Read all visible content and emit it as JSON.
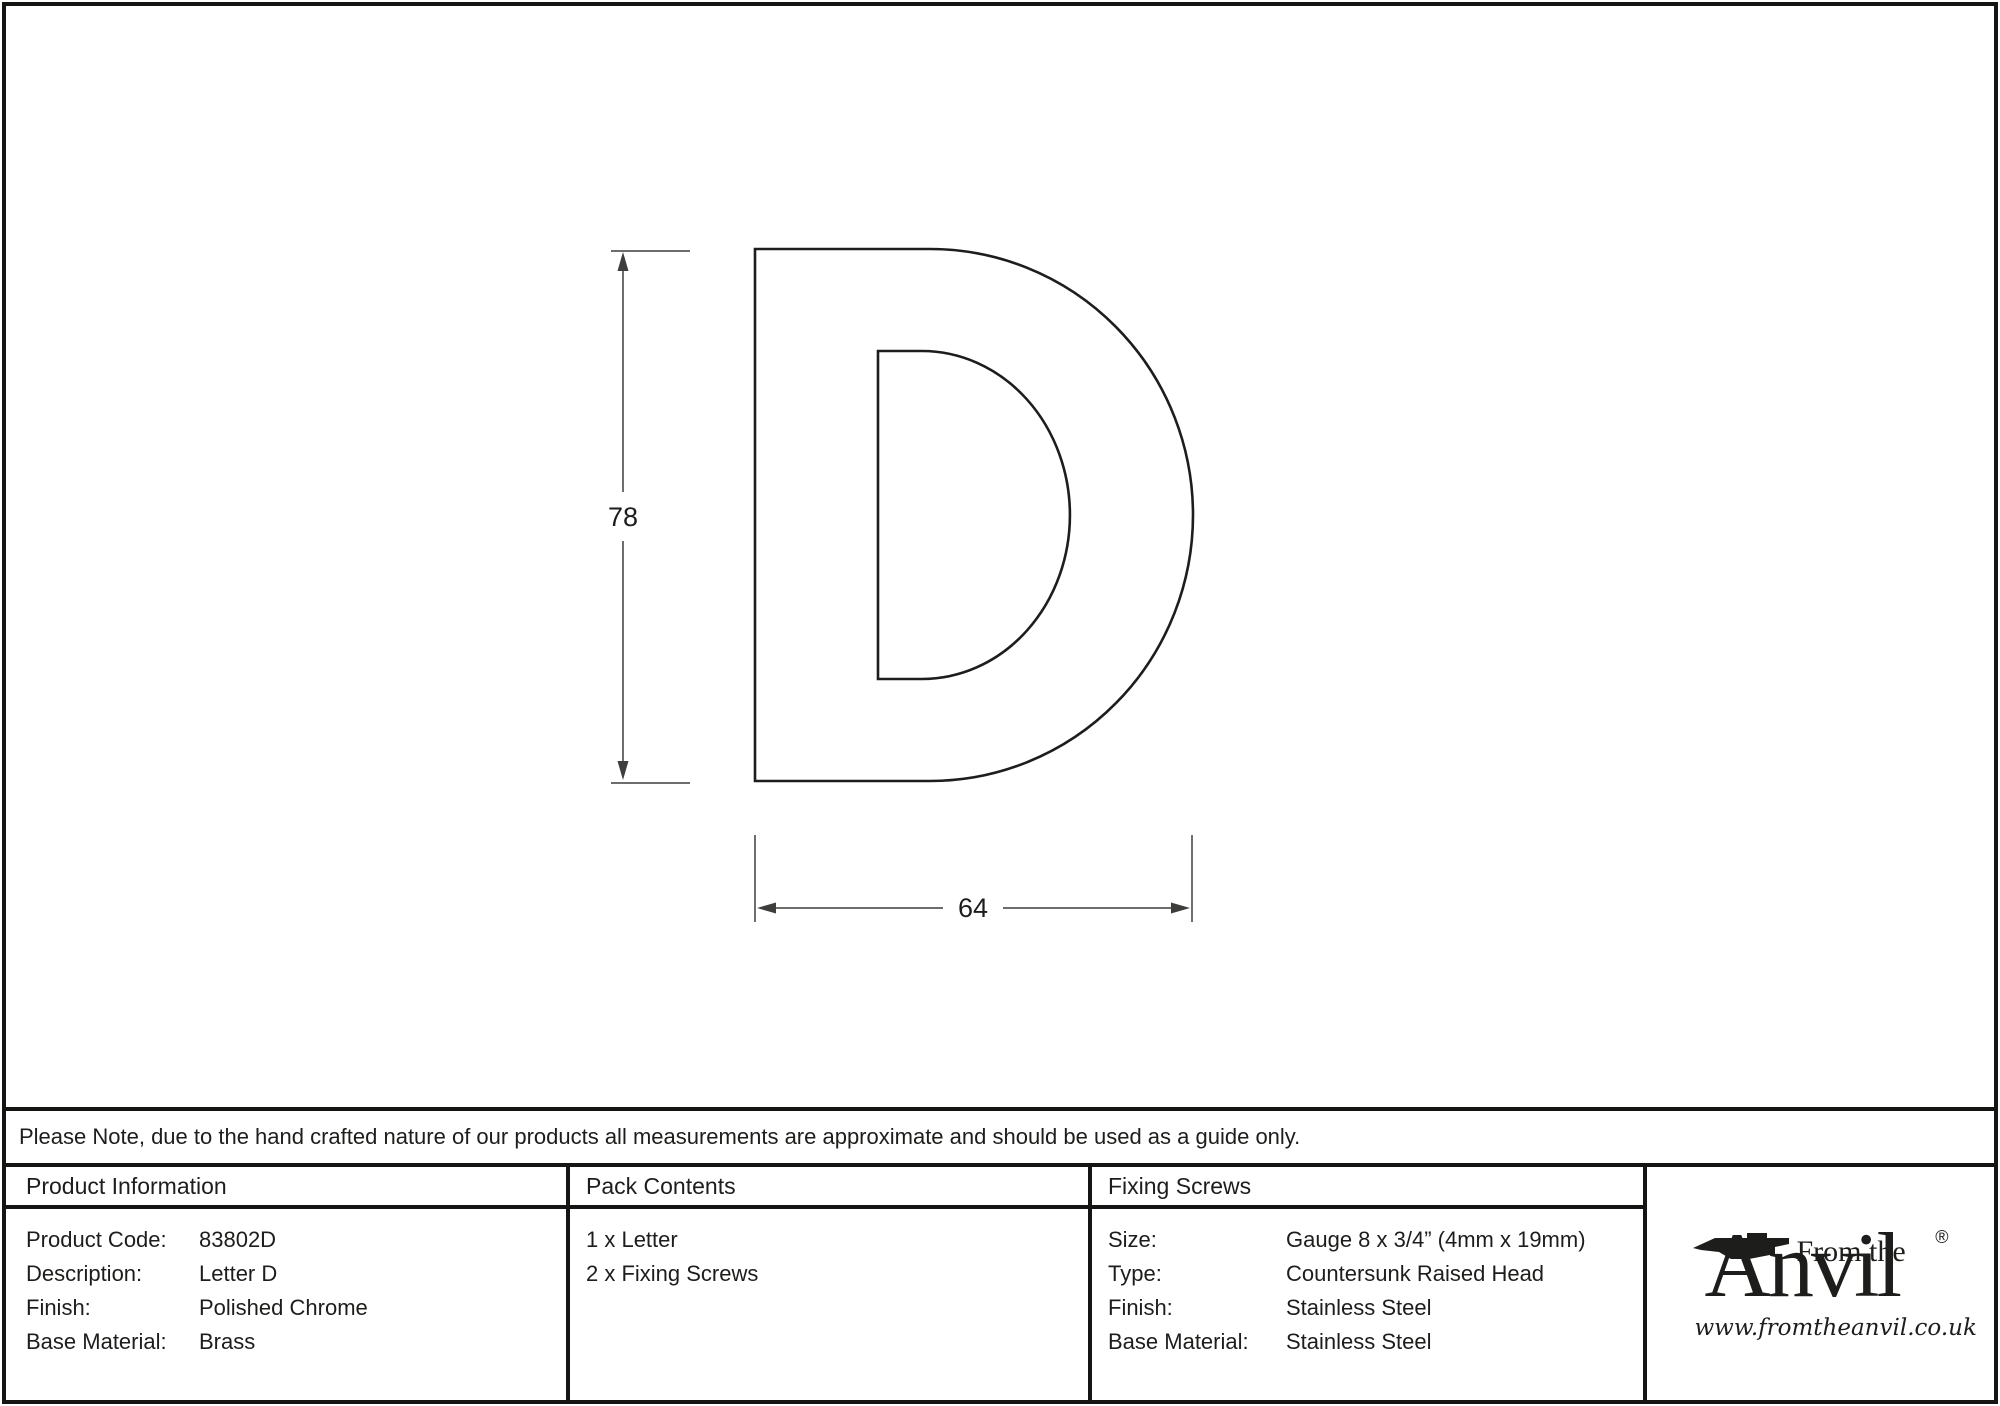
{
  "drawing": {
    "letter": "D",
    "height_label": "78",
    "width_label": "64"
  },
  "note": {
    "text": "Please Note, due to the hand crafted nature of our products all measurements are approximate and should be used as a guide only."
  },
  "product_information": {
    "header": "Product Information",
    "rows": [
      {
        "label": "Product Code:",
        "value": "83802D"
      },
      {
        "label": "Description:",
        "value": "Letter D"
      },
      {
        "label": "Finish:",
        "value": "Polished Chrome"
      },
      {
        "label": "Base Material:",
        "value": "Brass"
      }
    ]
  },
  "pack_contents": {
    "header": "Pack Contents",
    "items": [
      "1 x Letter",
      "2 x Fixing Screws"
    ]
  },
  "fixing_screws": {
    "header": "Fixing Screws",
    "rows": [
      {
        "label": "Size:",
        "value": "Gauge 8 x 3/4” (4mm x 19mm)"
      },
      {
        "label": "Type:",
        "value": "Countersunk Raised Head"
      },
      {
        "label": "Finish:",
        "value": "Stainless Steel"
      },
      {
        "label": "Base Material:",
        "value": "Stainless Steel"
      }
    ]
  },
  "logo": {
    "tagline": "From the",
    "brand": "Anvil",
    "registered": "®",
    "url": "www.fromtheanvil.co.uk"
  },
  "colors": {
    "ink": "#1d1d1b",
    "dim_line": "#3d3d3c",
    "border": "#151513"
  }
}
